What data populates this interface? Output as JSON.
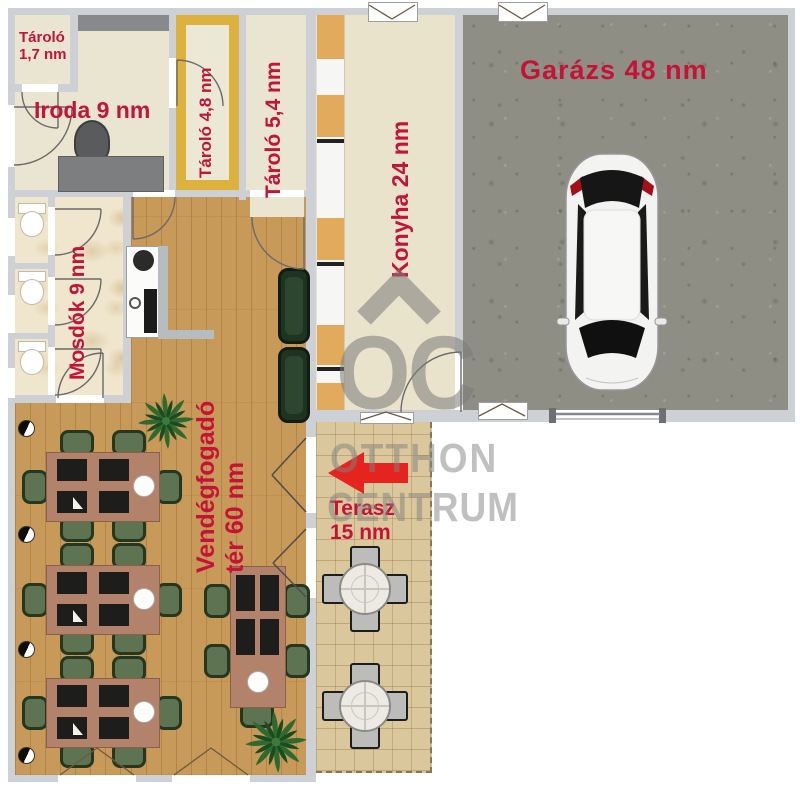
{
  "title": "Alaprajz - étterem és garázs",
  "rooms": {
    "tarolo_1_7": {
      "label": "Tároló\n1,7 nm"
    },
    "iroda": {
      "label": "Iroda 9 nm"
    },
    "tarolo_4_8": {
      "label": "Tároló 4,8 nm"
    },
    "tarolo_5_4": {
      "label": "Tároló 5,4 nm"
    },
    "konyha": {
      "label": "Konyha 24 nm"
    },
    "garazs": {
      "label": "Garázs 48 nm"
    },
    "mosdok": {
      "label": "Mosdók 9 nm"
    },
    "vendegfogado": {
      "label": "Vendégfogadó\ntér 60 nm"
    },
    "terasz": {
      "label": "Terasz\n15 nm"
    }
  },
  "watermark": {
    "logo": "OC",
    "line1": "OTTHON",
    "line2": "CENTRUM"
  },
  "colors": {
    "label_red": "#c51338",
    "arrow_red": "#e52420",
    "wall_gray": "#cdd1d5",
    "wood_floor": "#c79a59",
    "garage_floor": "#8e8e84",
    "terrace_tile": "#dac79c",
    "room_beige": "#eae5d1",
    "storage_yellow": "#ddb13e",
    "chair_green": "#5d7352",
    "watermark_gray": "#7a7c79"
  }
}
